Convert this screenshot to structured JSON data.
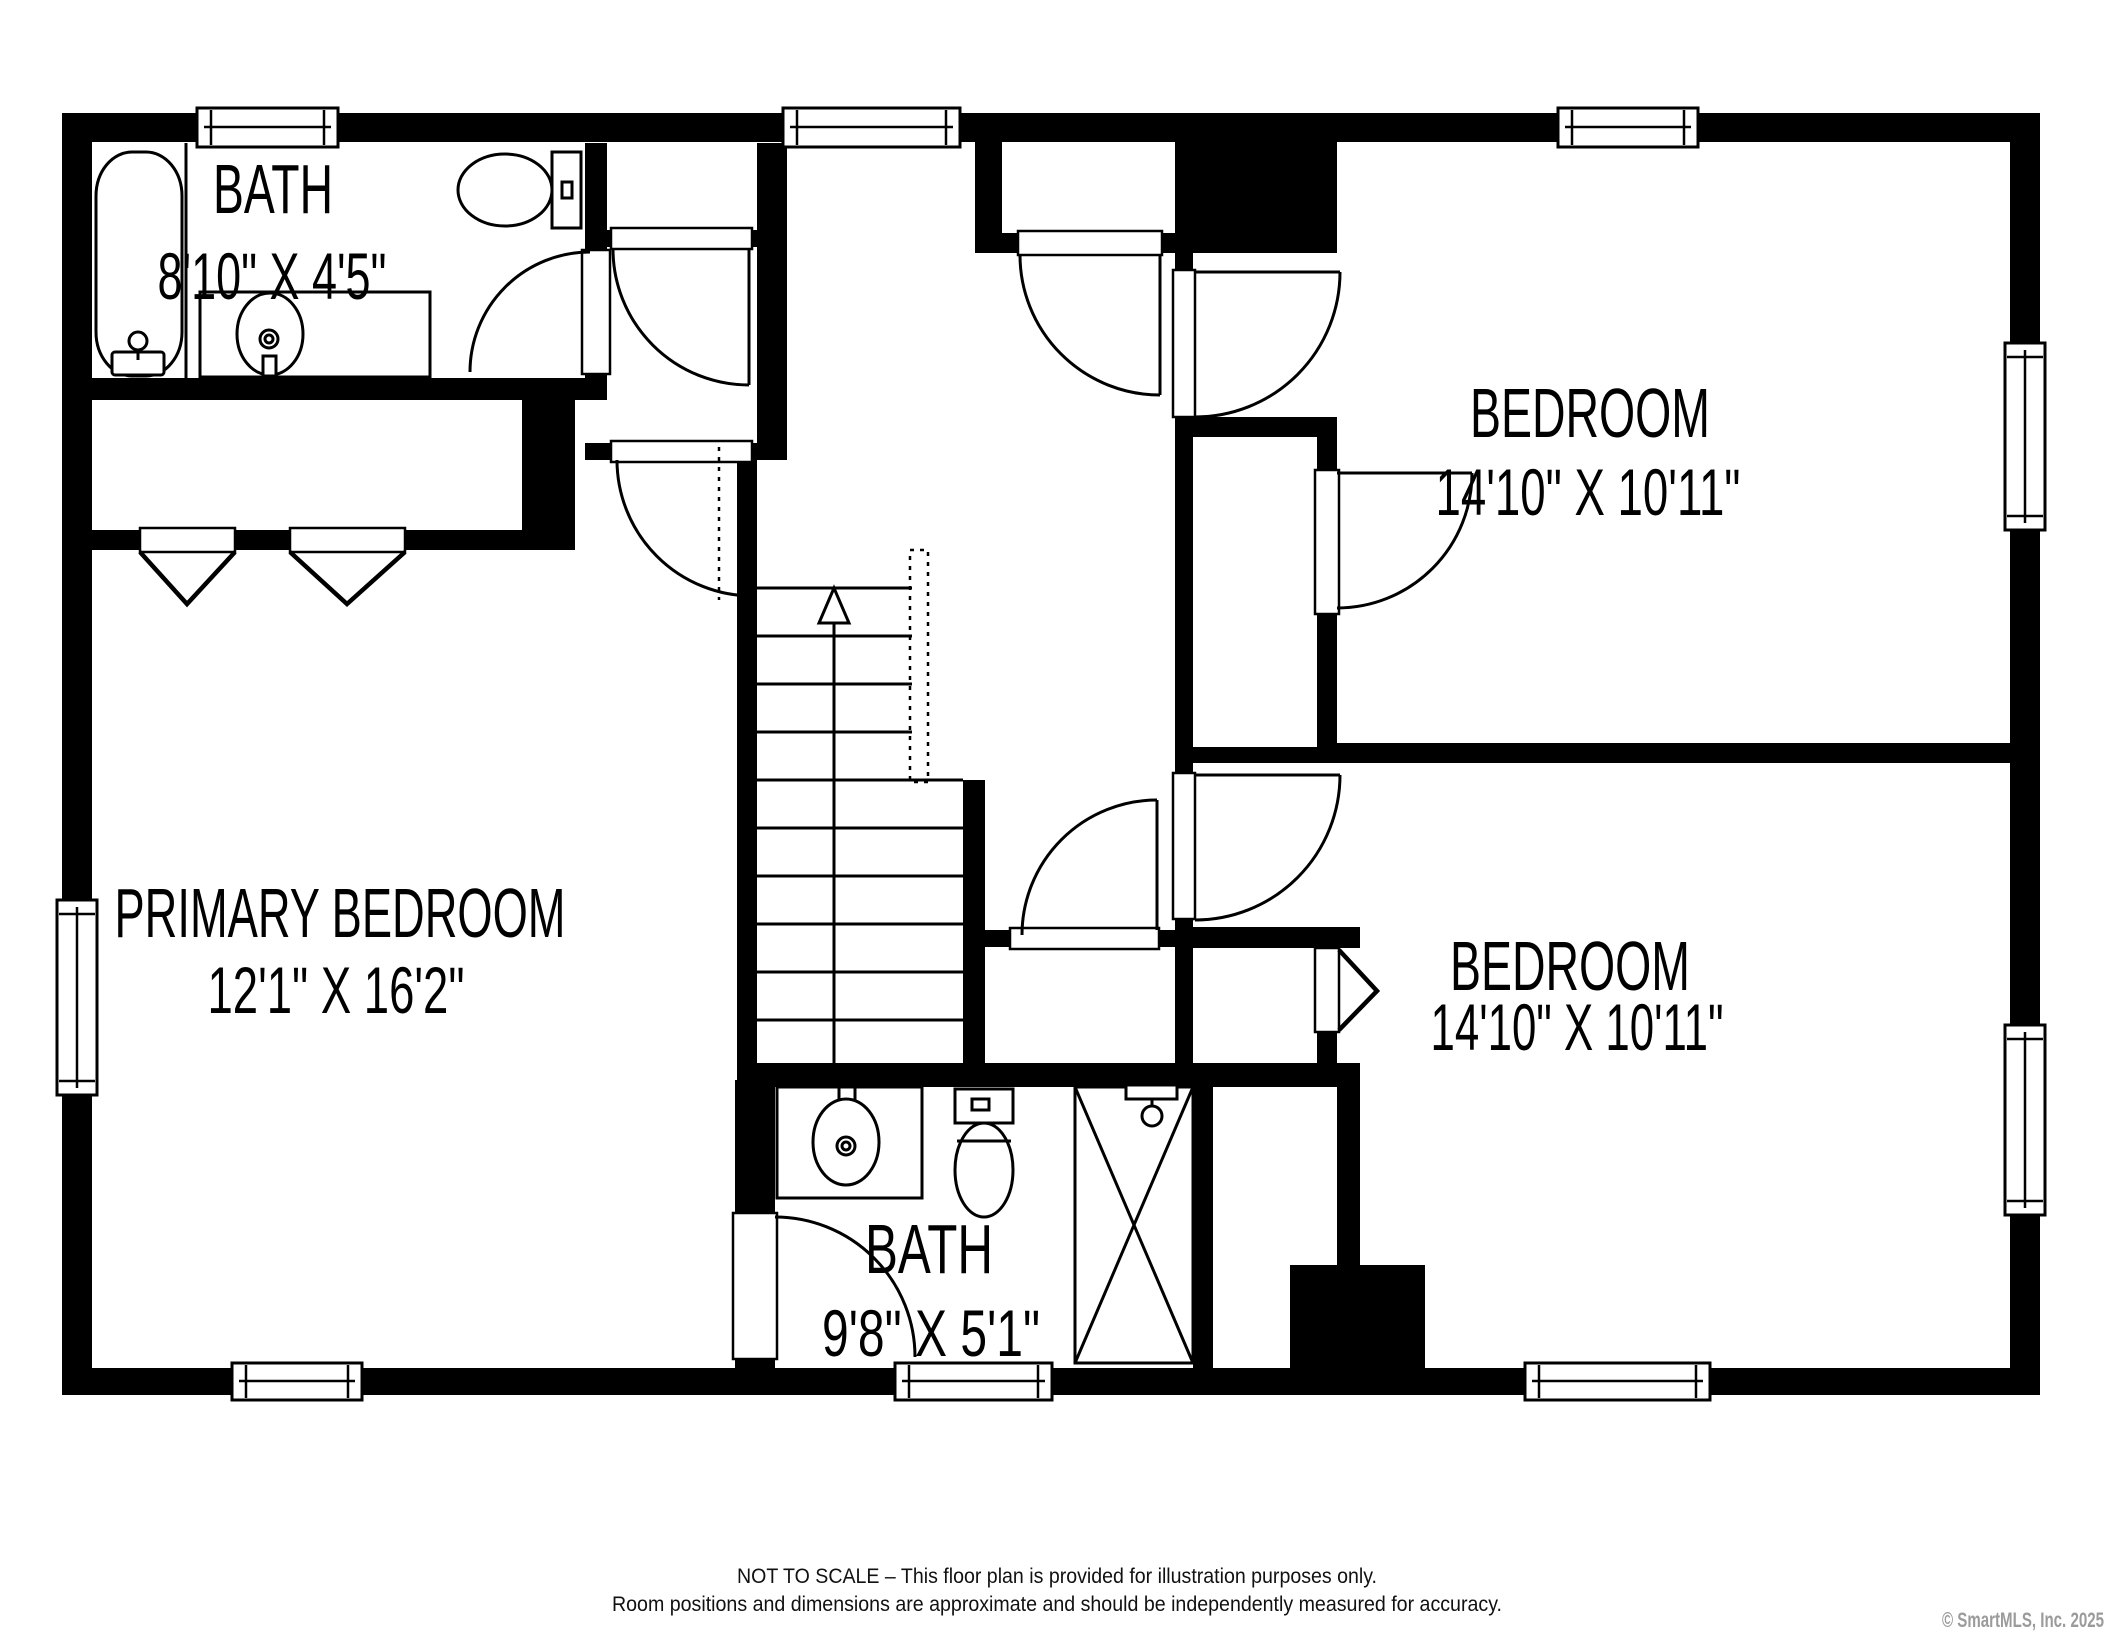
{
  "plan": {
    "type": "second-floor residential floor plan",
    "rooms": {
      "bath_top": {
        "name": "BATH",
        "dims": "8'10\" X 4'5\""
      },
      "bedroom_top": {
        "name": "BEDROOM",
        "dims": "14'10\" X 10'11\""
      },
      "primary": {
        "name": "PRIMARY BEDROOM",
        "dims": "12'1\" X 16'2\""
      },
      "bedroom_bottom": {
        "name": "BEDROOM",
        "dims": "14'10\" X 10'11\""
      },
      "bath_bottom": {
        "name": "BATH",
        "dims": "9'8\" X 5'1\""
      }
    },
    "fixtures": [
      "bathtub",
      "toilet",
      "sink",
      "shower",
      "stairs-up",
      "closet-bifold-doors"
    ],
    "colors": {
      "walls": "#000000",
      "background": "#ffffff",
      "copyright_gray": "#9b9b9b"
    }
  },
  "disclaimer": {
    "line1": "NOT TO SCALE – This floor plan is provided for illustration purposes only.",
    "line2": "Room positions and dimensions are approximate and should be independently measured for accuracy."
  },
  "copyright": "© SmartMLS, Inc. 2025"
}
